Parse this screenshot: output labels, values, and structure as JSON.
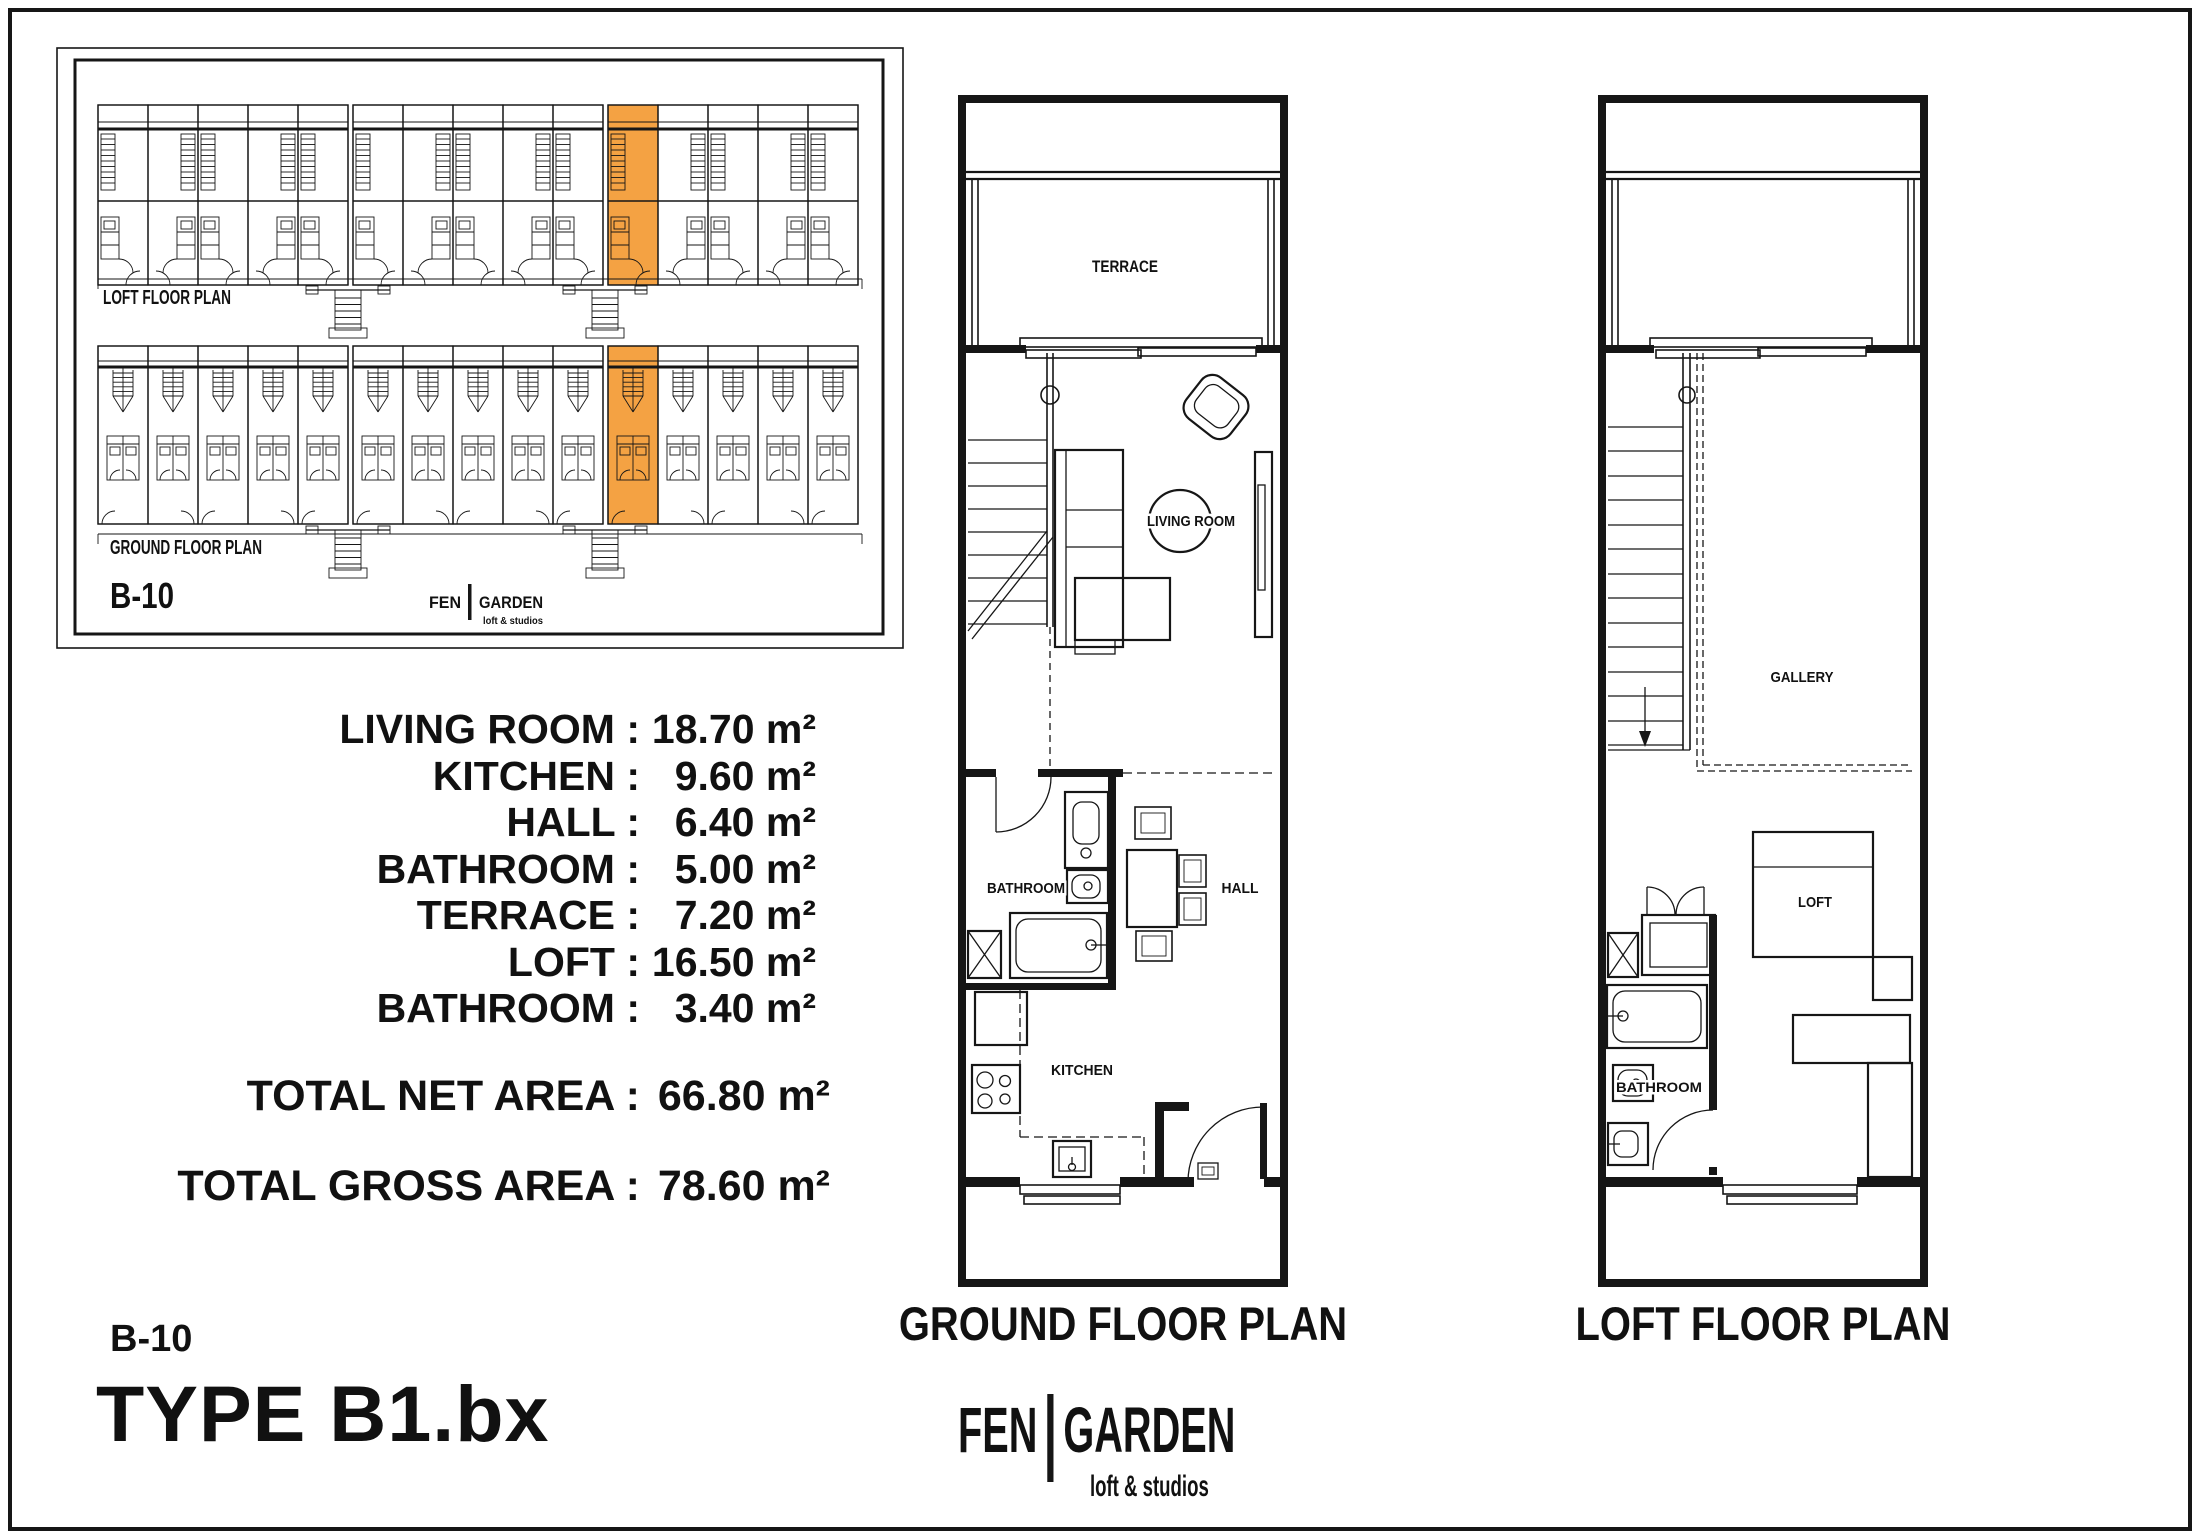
{
  "sheet": {
    "type_title": "TYPE B1.bx",
    "unit_code": "B-10"
  },
  "colors": {
    "highlight": "#F4A243",
    "line": "#161616"
  },
  "key_plan": {
    "loft_row_label": "LOFT FLOOR PLAN",
    "ground_row_label": "GROUND FLOOR PLAN",
    "unit_code": "B-10",
    "logo": {
      "left": "FEN",
      "right": "GARDEN",
      "tagline": "loft & studios"
    }
  },
  "area_table": {
    "rows": [
      {
        "label": "LIVING ROOM :",
        "value": "18.70 m²"
      },
      {
        "label": "KITCHEN :",
        "value": "9.60 m²"
      },
      {
        "label": "HALL :",
        "value": "6.40 m²"
      },
      {
        "label": "BATHROOM :",
        "value": "5.00 m²"
      },
      {
        "label": "TERRACE :",
        "value": "7.20 m²"
      },
      {
        "label": "LOFT :",
        "value": "16.50 m²"
      },
      {
        "label": "BATHROOM :",
        "value": "3.40 m²"
      }
    ],
    "totals": [
      {
        "label": "TOTAL NET AREA :",
        "value": "66.80 m²"
      },
      {
        "label": "TOTAL GROSS AREA :",
        "value": "78.60 m²"
      }
    ]
  },
  "ground_plan": {
    "title": "GROUND FLOOR PLAN",
    "labels": {
      "terrace": "TERRACE",
      "living_room": "LIVING ROOM",
      "bathroom": "BATHROOM",
      "hall": "HALL",
      "kitchen": "KITCHEN"
    }
  },
  "loft_plan": {
    "title": "LOFT FLOOR PLAN",
    "labels": {
      "gallery": "GALLERY",
      "loft": "LOFT",
      "bathroom": "BATHROOM"
    }
  },
  "brand": {
    "left": "FEN",
    "right": "GARDEN",
    "tagline": "loft & studios"
  }
}
